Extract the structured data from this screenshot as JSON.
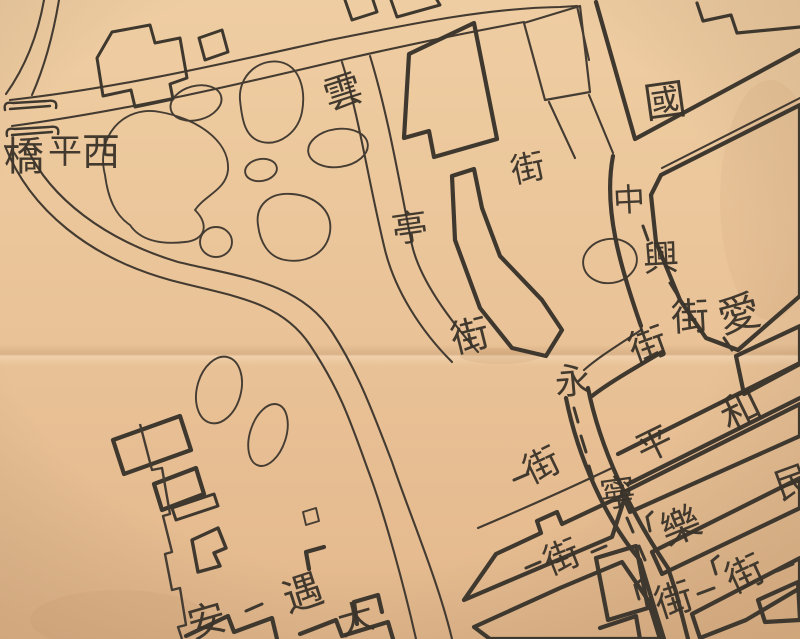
{
  "map": {
    "kind": "historical ink street map on aged paper (cropped sheet)",
    "colors": {
      "paper_light": "#efcda2",
      "paper_mid": "#e9c096",
      "paper_dark": "#ddab7e",
      "ink": "#403930",
      "crease": "#8a5c33"
    },
    "streets_named": [
      {
        "name": "西平橋",
        "kind": "bridge"
      },
      {
        "name": "雲亭街",
        "kind": "street"
      },
      {
        "name": "中興街",
        "kind": "street"
      },
      {
        "name": "永寧街",
        "kind": "street"
      },
      {
        "name": "和平街",
        "kind": "street"
      }
    ],
    "labels": [
      {
        "text": "橋",
        "x": 24,
        "y": 157,
        "rot": 0,
        "size": 40,
        "group": "西平橋"
      },
      {
        "text": "平",
        "x": 65,
        "y": 152,
        "rot": 0,
        "size": 34,
        "group": "西平橋"
      },
      {
        "text": "西",
        "x": 101,
        "y": 152,
        "rot": 0,
        "size": 38,
        "group": "西平橋"
      },
      {
        "text": "雲",
        "x": 343,
        "y": 92,
        "rot": -18,
        "size": 38,
        "group": "雲亭街"
      },
      {
        "text": "亭",
        "x": 410,
        "y": 229,
        "rot": -8,
        "size": 36,
        "group": "雲亭街"
      },
      {
        "text": "街",
        "x": 470,
        "y": 336,
        "rot": -14,
        "size": 38,
        "group": "雲亭街"
      },
      {
        "text": "街",
        "x": 528,
        "y": 169,
        "rot": -12,
        "size": 34,
        "group": "street-label"
      },
      {
        "text": "國",
        "x": 665,
        "y": 101,
        "rot": -8,
        "size": 42,
        "group": "street-label"
      },
      {
        "text": "中",
        "x": 629,
        "y": 200,
        "rot": -3,
        "size": 32,
        "group": "中興街"
      },
      {
        "text": "興",
        "x": 661,
        "y": 259,
        "rot": -3,
        "size": 36,
        "group": "中興街"
      },
      {
        "text": "街",
        "x": 690,
        "y": 317,
        "rot": -3,
        "size": 38,
        "group": "中興街"
      },
      {
        "text": "愛",
        "x": 739,
        "y": 314,
        "rot": -15,
        "size": 42,
        "group": "street-label"
      },
      {
        "text": "街",
        "x": 648,
        "y": 345,
        "rot": -20,
        "size": 38,
        "group": "street-label"
      },
      {
        "text": "永",
        "x": 573,
        "y": 382,
        "rot": -5,
        "size": 36,
        "group": "永寧街"
      },
      {
        "text": "寧",
        "x": 618,
        "y": 494,
        "rot": -8,
        "size": 36,
        "group": "永寧街"
      },
      {
        "text": "街",
        "x": 674,
        "y": 600,
        "rot": -18,
        "size": 38,
        "group": "永寧街"
      },
      {
        "text": "和",
        "x": 741,
        "y": 411,
        "rot": -26,
        "size": 40,
        "group": "和平街"
      },
      {
        "text": "平",
        "x": 655,
        "y": 445,
        "rot": -26,
        "size": 36,
        "group": "和平街"
      },
      {
        "text": "街",
        "x": 542,
        "y": 466,
        "rot": -26,
        "size": 36,
        "group": "和平街"
      },
      {
        "text": "樂",
        "x": 681,
        "y": 527,
        "rot": -22,
        "size": 40,
        "group": "street-label"
      },
      {
        "text": "街",
        "x": 745,
        "y": 574,
        "rot": -25,
        "size": 38,
        "group": "street-label"
      },
      {
        "text": "街",
        "x": 562,
        "y": 558,
        "rot": -22,
        "size": 36,
        "group": "street-label"
      },
      {
        "text": "民",
        "x": 793,
        "y": 483,
        "rot": -20,
        "size": 36,
        "group": "street-label"
      },
      {
        "text": "遇",
        "x": 303,
        "y": 594,
        "rot": -18,
        "size": 40,
        "group": "street-label"
      },
      {
        "text": "安",
        "x": 207,
        "y": 621,
        "rot": -16,
        "size": 38,
        "group": "street-label"
      },
      {
        "text": "大",
        "x": 356,
        "y": 620,
        "rot": -16,
        "size": 36,
        "group": "street-label"
      }
    ]
  }
}
